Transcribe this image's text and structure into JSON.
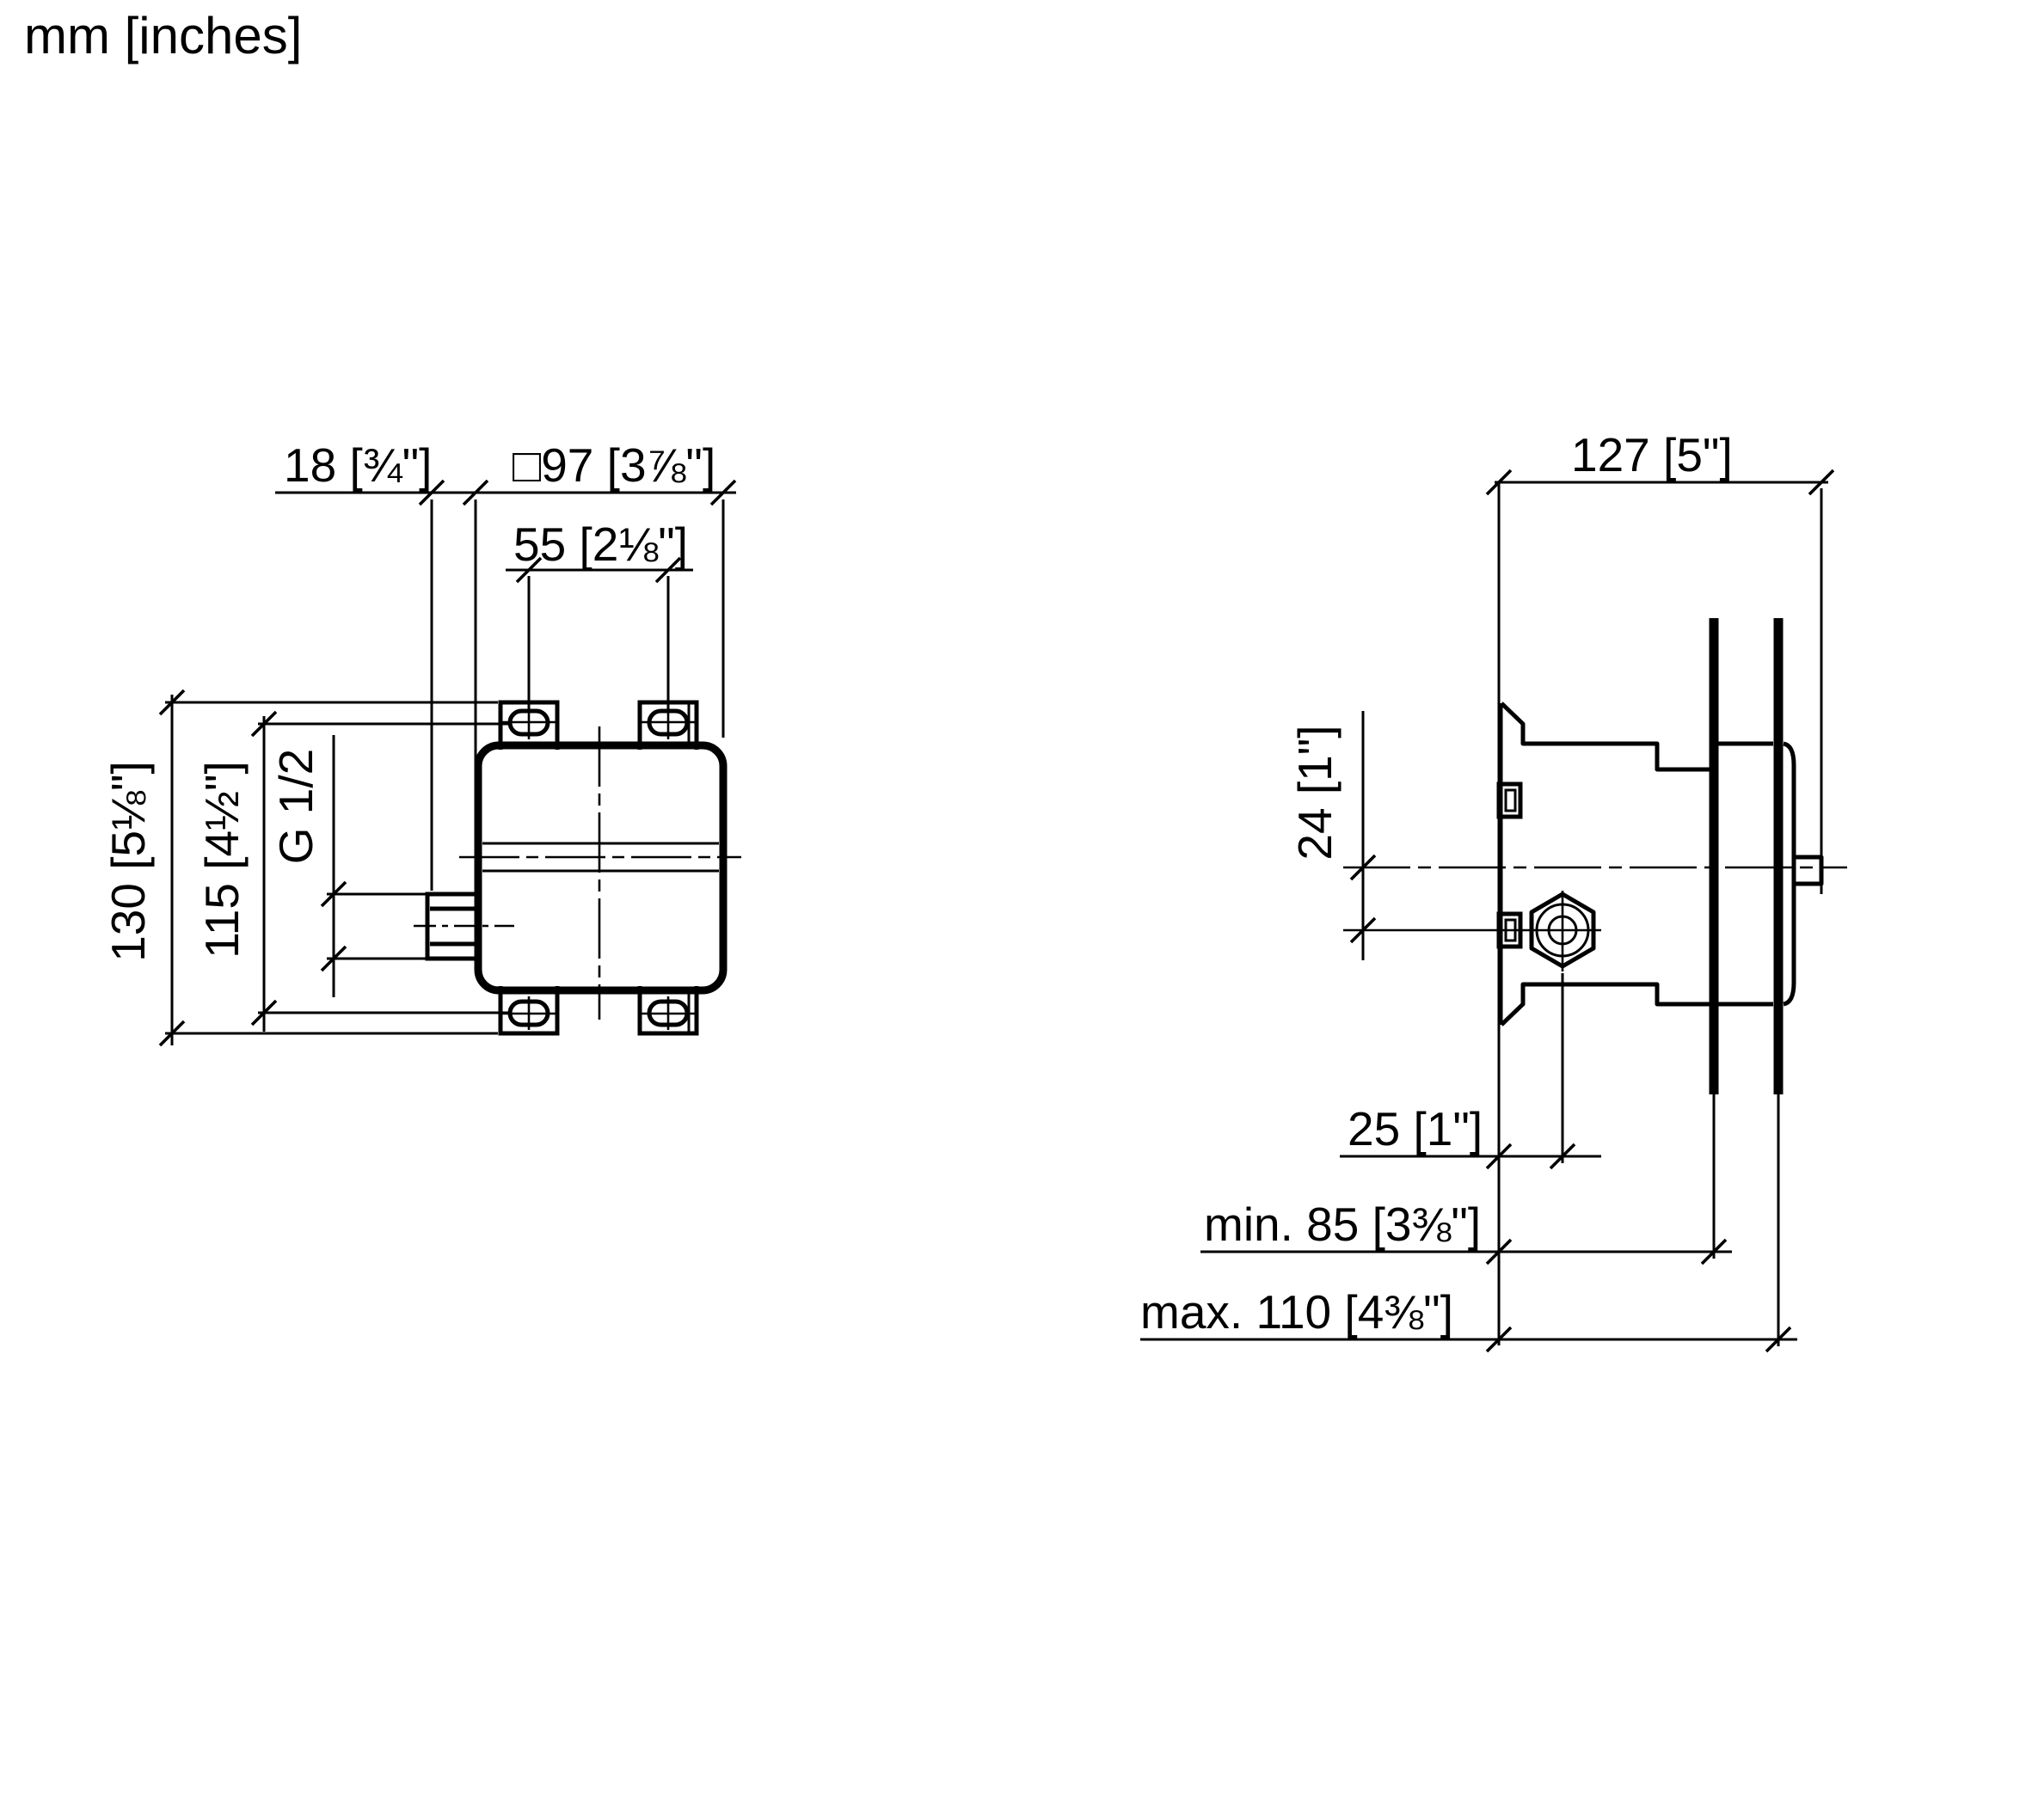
{
  "meta": {
    "type": "technical-installation-drawing",
    "views": [
      "front view of concealed valve body",
      "side section view in wall"
    ],
    "colors": {
      "line": "#000000",
      "background": "#ffffff"
    }
  },
  "page": {
    "units": "mm [inches]"
  },
  "front_view": {
    "name": "concealed valve body front view",
    "dimensions": {
      "nut_projection": "18 [¾\"]",
      "body_square": "□97 [3⅞\"]",
      "slot_spacing_horizontal": "55 [2⅛\"]",
      "overall_height": "130 [5⅛\"]",
      "slot_spacing_vertical": "115 [4½\"]",
      "thread": "G 1/2"
    }
  },
  "side_view": {
    "name": "concealed valve body side view with wall build-up",
    "dimensions": {
      "overall_depth": "127 [5\"]",
      "outlet_offset": "24 [1\"]",
      "outlet_depth": "25 [1\"]",
      "install_depth_min": "min. 85 [3⅜\"]",
      "install_depth_max": "max. 110 [4⅜\"]"
    }
  }
}
